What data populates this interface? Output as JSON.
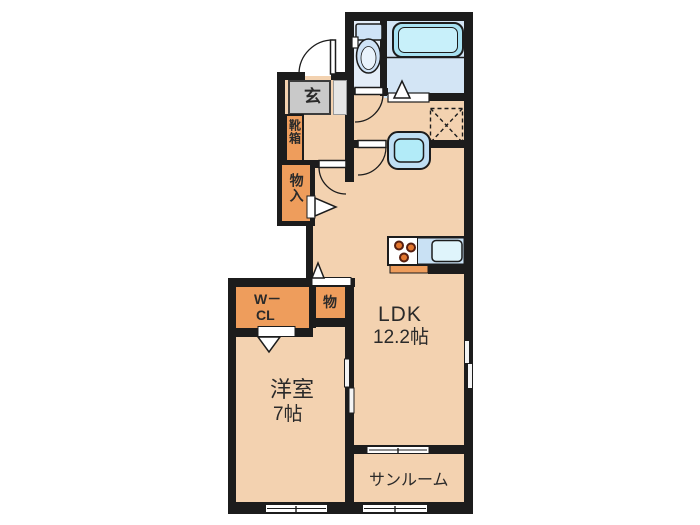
{
  "rooms": {
    "entrance": "玄",
    "shoe_cabinet": "靴箱",
    "hall_storage": "物入",
    "storage": "物",
    "wcl_line1": "W－",
    "wcl_line2": "CL",
    "ldk_name": "LDK",
    "ldk_size": "12.2帖",
    "western_room_name": "洋室",
    "western_room_size": "7帖",
    "sunroom": "サンルーム"
  },
  "colors": {
    "floor": "#f3d2b0",
    "storage_accent": "#ee9d5c",
    "wall": "#1c1c1c",
    "toilet_floor": "#e3edf8",
    "bath_floor": "#d3e5f5",
    "tub_cyan": "#a8e2f2",
    "fixture_blue": "#c9e1f4",
    "entrance_gray": "#c9c9c9",
    "background": "#ffffff"
  }
}
